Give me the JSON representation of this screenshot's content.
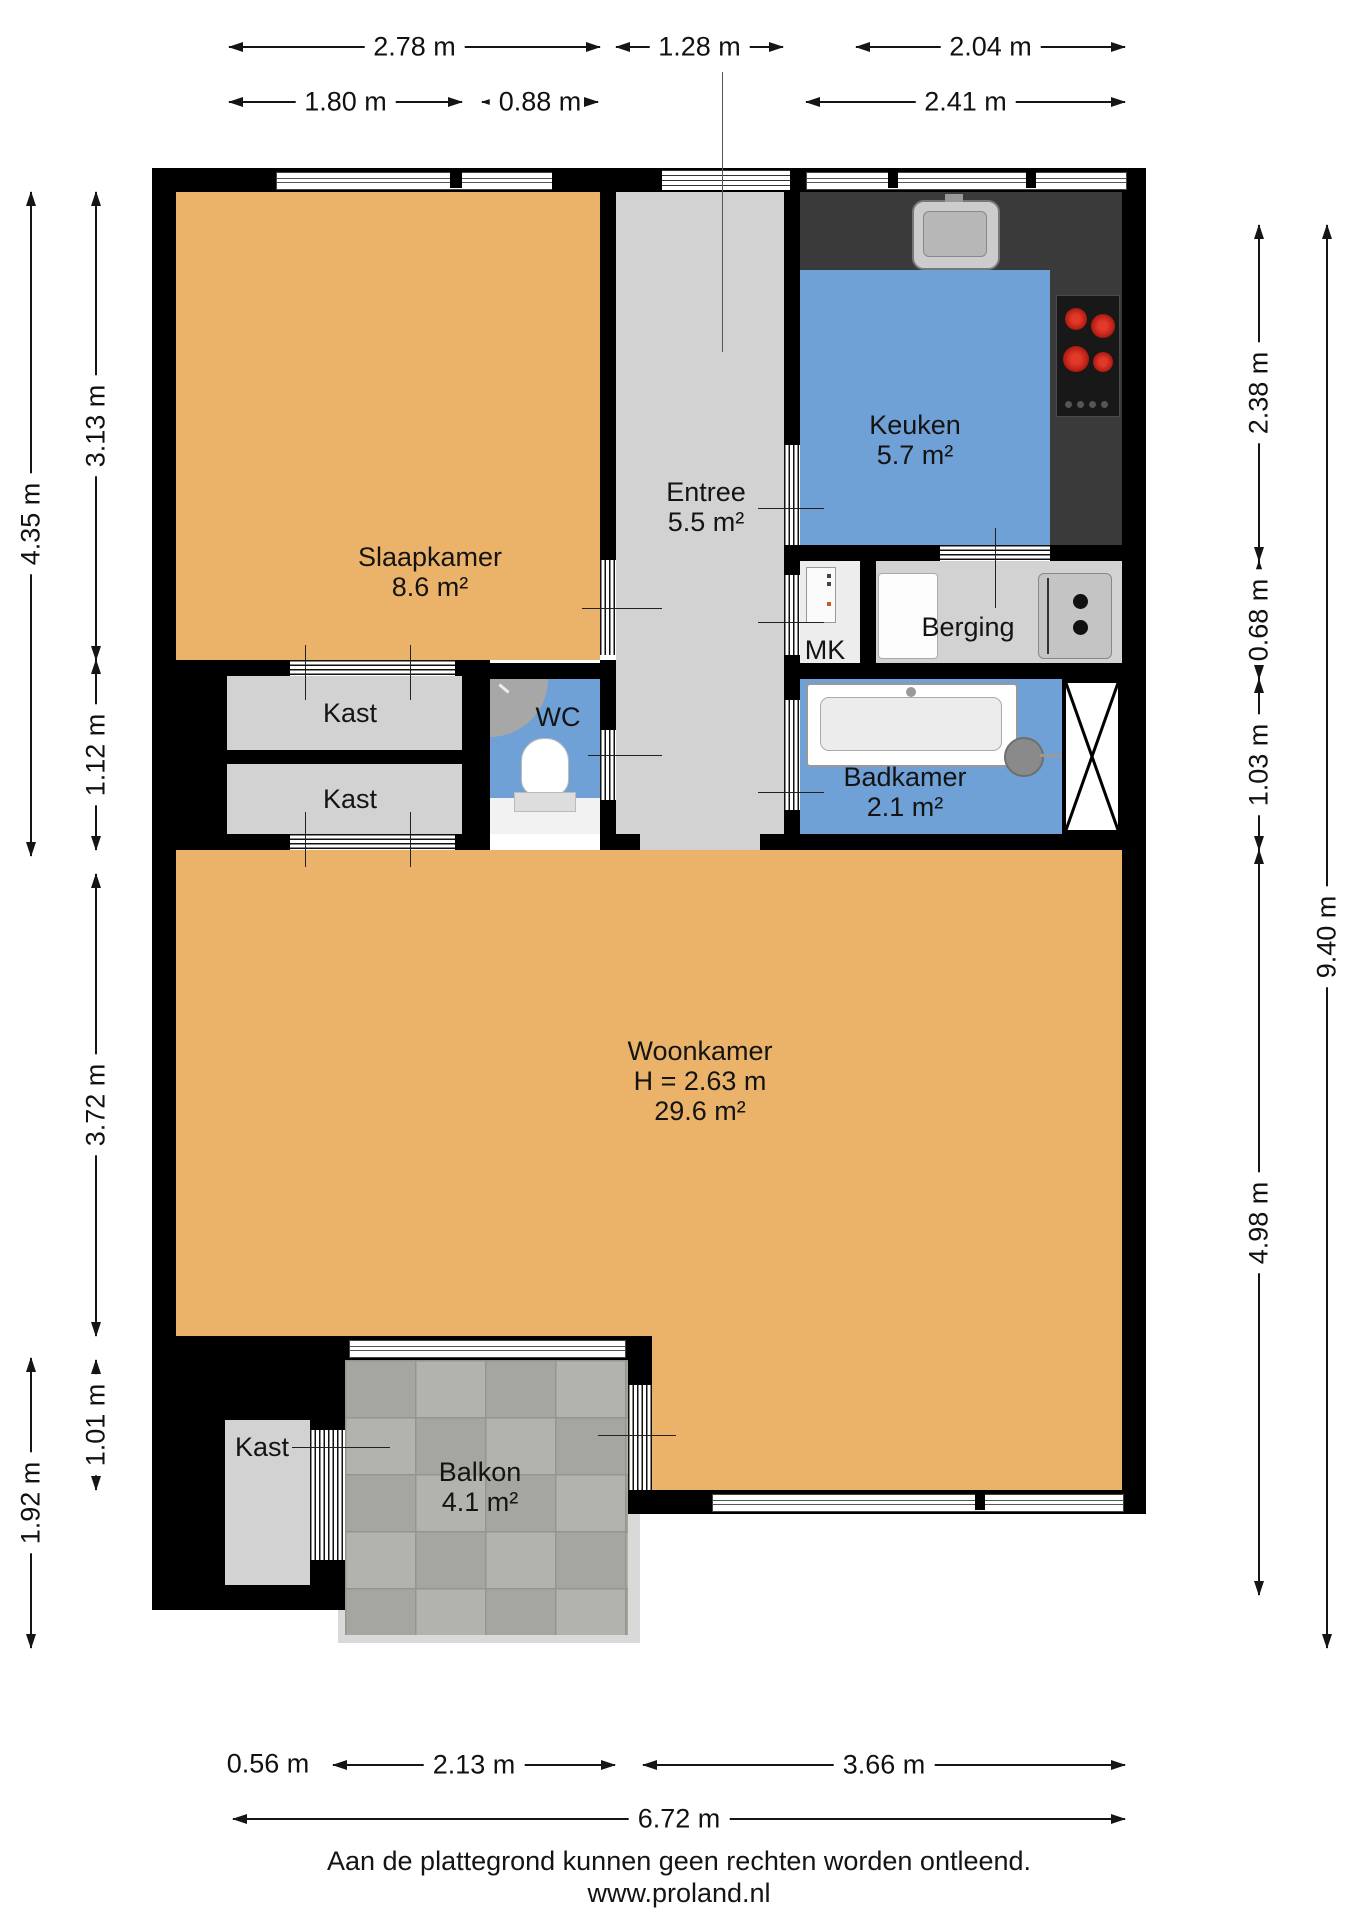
{
  "colors": {
    "wall": "#000000",
    "floor_orange": "#EBB369",
    "floor_blue": "#6FA0D6",
    "floor_gray": "#D2D2D2",
    "counter": "#3A3A3A",
    "tile": "#ABABA7",
    "burner_red": "#C9261A"
  },
  "rooms": {
    "slaapkamer": {
      "name": "Slaapkamer",
      "area": "8.6 m²"
    },
    "entree": {
      "name": "Entree",
      "area": "5.5 m²"
    },
    "keuken": {
      "name": "Keuken",
      "area": "5.7 m²"
    },
    "mk": {
      "name": "MK"
    },
    "berging": {
      "name": "Berging"
    },
    "kast_boven": {
      "name": "Kast"
    },
    "kast_onder": {
      "name": "Kast"
    },
    "wc": {
      "name": "WC"
    },
    "badkamer": {
      "name": "Badkamer",
      "area": "2.1 m²"
    },
    "woonkamer": {
      "name": "Woonkamer",
      "height": "H = 2.63 m",
      "area": "29.6 m²"
    },
    "kast_balkon": {
      "name": "Kast"
    },
    "balkon": {
      "name": "Balkon",
      "area": "4.1 m²"
    }
  },
  "dimensions": {
    "top_row1": [
      {
        "label": "2.78 m"
      },
      {
        "label": "1.28 m"
      },
      {
        "label": "2.04 m"
      }
    ],
    "top_row2": [
      {
        "label": "1.80 m"
      },
      {
        "label": "0.88 m"
      },
      {
        "label": "2.41 m"
      }
    ],
    "bottom_row1": [
      {
        "label": "0.56 m"
      },
      {
        "label": "2.13 m"
      },
      {
        "label": "3.66 m"
      }
    ],
    "bottom_row2": [
      {
        "label": "6.72 m"
      }
    ],
    "left_outer": [
      {
        "label": "4.35 m"
      },
      {
        "label": "1.92 m"
      }
    ],
    "left_inner": [
      {
        "label": "3.13 m"
      },
      {
        "label": "1.12 m"
      },
      {
        "label": "3.72 m"
      },
      {
        "label": "1.01 m"
      }
    ],
    "right_inner": [
      {
        "label": "2.38 m"
      },
      {
        "label": "0.68 m"
      },
      {
        "label": "1.03 m"
      },
      {
        "label": "4.98 m"
      }
    ],
    "right_outer": [
      {
        "label": "9.40 m"
      }
    ]
  },
  "footer": {
    "disclaimer": "Aan de plattegrond kunnen geen rechten worden ontleend.",
    "website": "www.proland.nl"
  }
}
